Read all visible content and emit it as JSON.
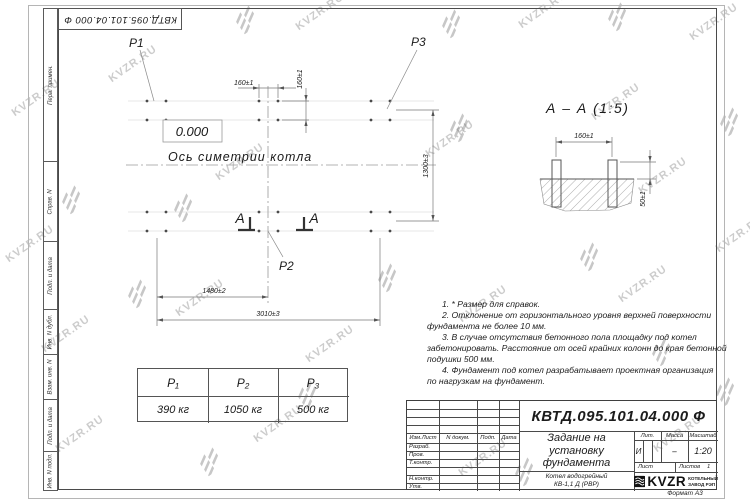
{
  "page": {
    "format_label": "Формат А3"
  },
  "stamp_top": {
    "number": "КВТД.095.101.04.000  Ф"
  },
  "sidebar": {
    "cells": [
      {
        "label": "Перв. примен."
      },
      {
        "label": "Справ. N"
      },
      {
        "label": "Подп. и дата"
      },
      {
        "label": "Инв. N дубл."
      },
      {
        "label": "Взам. инв. N"
      },
      {
        "label": "Подп. и дата"
      },
      {
        "label": "Инв. N подл."
      }
    ]
  },
  "plan": {
    "p1": "Р1",
    "p2": "Р2",
    "p3": "Р3",
    "elevation": "0.000",
    "axis_label": "Ось симетрии котла",
    "section_letter": "А",
    "dims": {
      "d160h": "160±1",
      "d160v": "160±1",
      "d1300": "1300±3",
      "d1480": "1480±2",
      "d3010": "3010±3"
    }
  },
  "section": {
    "title": "А – А (1:5)",
    "dims": {
      "d160": "160±1",
      "d50": "50±1"
    }
  },
  "notes": {
    "lines": [
      "1. * Размер для справок.",
      "2. Отклонение от горизонтального уровня верхней поверхности",
      "фундамента не более 10 мм.",
      "3. В случае отсутствия бетонного пола площадку под котел",
      "забетонировать. Расстояние от осей крайних колонн до края бетонной",
      "подушки 500 мм.",
      "4. Фундамент под котел разрабатывает проектная организация",
      "по нагрузкам на фундамент."
    ]
  },
  "load_table": {
    "headers": [
      "P₁",
      "P₂",
      "P₃"
    ],
    "values": [
      "390 кг",
      "1050 кг",
      "500 кг"
    ]
  },
  "title_block": {
    "number": "КВТД.095.101.04.000  Ф",
    "title_lines": [
      "Задание на",
      "установку",
      "фундамента"
    ],
    "product_lines": [
      "Котел водогрейный",
      "КВ-1,1 Д (РВР)"
    ],
    "header_cols": {
      "izm": "Изм.Лист",
      "doc": "N докум.",
      "sign": "Подп.",
      "date": "Дата"
    },
    "rows": [
      "Разраб.",
      "Пров.",
      "Т.контр.",
      "",
      "Н.контр.",
      "Утв."
    ],
    "lit_label": "Лит.",
    "mass_label": "Масса",
    "scale_label": "Масштаб",
    "lit_value": "И",
    "mass_value": "–",
    "scale_value": "1:20",
    "sheet_label": "Лист",
    "sheets_label": "Листов",
    "sheets_value": "1",
    "logo_text": "KVZR",
    "logo_caption_lines": [
      "КОТЕЛЬНЫЙ",
      "ЗАВОД РЭП"
    ]
  },
  "watermark": {
    "text": "KVZR.RU",
    "color": "#c6c6c6",
    "items": [
      {
        "k": "t",
        "x": 8,
        "y": 92
      },
      {
        "k": "t",
        "x": 105,
        "y": 58
      },
      {
        "k": "t",
        "x": 292,
        "y": 6
      },
      {
        "k": "t",
        "x": 515,
        "y": 4
      },
      {
        "k": "t",
        "x": 686,
        "y": 16
      },
      {
        "k": "t",
        "x": 2,
        "y": 238
      },
      {
        "k": "t",
        "x": 212,
        "y": 156
      },
      {
        "k": "t",
        "x": 422,
        "y": 133
      },
      {
        "k": "t",
        "x": 588,
        "y": 96
      },
      {
        "k": "t",
        "x": 635,
        "y": 170
      },
      {
        "k": "t",
        "x": 38,
        "y": 328
      },
      {
        "k": "t",
        "x": 172,
        "y": 292
      },
      {
        "k": "t",
        "x": 455,
        "y": 298
      },
      {
        "k": "t",
        "x": 615,
        "y": 278
      },
      {
        "k": "t",
        "x": 52,
        "y": 428
      },
      {
        "k": "t",
        "x": 250,
        "y": 418
      },
      {
        "k": "t",
        "x": 455,
        "y": 452
      },
      {
        "k": "t",
        "x": 650,
        "y": 428
      },
      {
        "k": "t",
        "x": 712,
        "y": 228
      },
      {
        "k": "t",
        "x": 302,
        "y": 338
      },
      {
        "k": "l",
        "x": 236,
        "y": 8
      },
      {
        "k": "l",
        "x": 442,
        "y": 12
      },
      {
        "k": "l",
        "x": 608,
        "y": 5
      },
      {
        "k": "l",
        "x": 62,
        "y": 188
      },
      {
        "k": "l",
        "x": 174,
        "y": 196
      },
      {
        "k": "l",
        "x": 450,
        "y": 116
      },
      {
        "k": "l",
        "x": 720,
        "y": 110
      },
      {
        "k": "l",
        "x": 128,
        "y": 282
      },
      {
        "k": "l",
        "x": 378,
        "y": 266
      },
      {
        "k": "l",
        "x": 580,
        "y": 245
      },
      {
        "k": "l",
        "x": 298,
        "y": 383
      },
      {
        "k": "l",
        "x": 652,
        "y": 340
      },
      {
        "k": "l",
        "x": 200,
        "y": 450
      },
      {
        "k": "l",
        "x": 515,
        "y": 460
      },
      {
        "k": "l",
        "x": 716,
        "y": 380
      }
    ]
  }
}
